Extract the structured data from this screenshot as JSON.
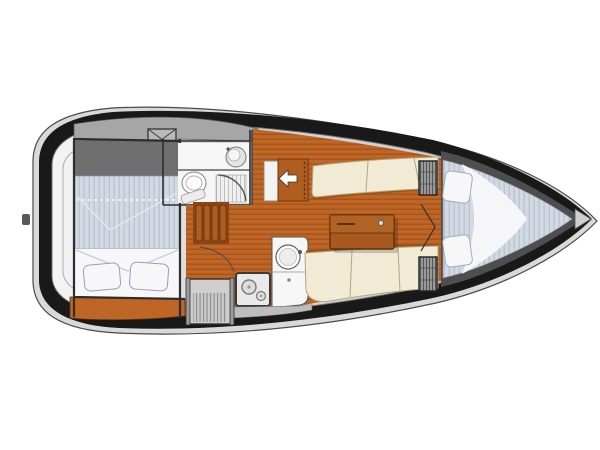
{
  "diagram": {
    "type": "sailboat-interior-floorplan",
    "orientation": "bow-right",
    "regions": [
      {
        "id": "aft-cabin",
        "label": "aft double berth cabin"
      },
      {
        "id": "head",
        "label": "head compartment with sink, toilet and shower"
      },
      {
        "id": "deck-hatch",
        "label": "crosshatched deck hatch"
      },
      {
        "id": "galley",
        "label": "galley with round sink and two-burner stove"
      },
      {
        "id": "companionway-steps",
        "label": "companionway steps"
      },
      {
        "id": "salon",
        "label": "salon with port and starboard settees and table"
      },
      {
        "id": "entry-arrow",
        "label": "entry direction arrow pointing aft"
      },
      {
        "id": "hanging-lockers",
        "label": "louvered hanging lockers at forward bulkhead"
      },
      {
        "id": "v-berth",
        "label": "forward V-berth with two pillows"
      },
      {
        "id": "anchor-locker",
        "label": "bow anchor locker"
      }
    ]
  },
  "colors": {
    "hull_dark": "#191919",
    "hull_side": "#d9d9d9",
    "deck_light": "#f2f2f2",
    "deck_mid": "#cfcfcf",
    "cockpit_gray": "#a6a6a6",
    "cabin_top_gray": "#6f6f6f",
    "wood": "#bf6526",
    "wood_plank_line": "#a0511c",
    "wood_furniture": "#a8591f",
    "wood_cabinet": "#b05e20",
    "wood_trim_dark": "#6b350f",
    "cushion": "#f1ead4",
    "cushion_edge": "#b3a582",
    "mattress": "#d2d9e2",
    "mattress_stripe": "#bac3d0",
    "sheet_white": "#f7f7f9",
    "fixture_white": "#f6f6f6",
    "steps_gray": "#cfcfcf",
    "locker_gray": "#9a9a9a",
    "bow_wall_gray": "#4e4e4e",
    "outline": "#2d2d2d"
  }
}
